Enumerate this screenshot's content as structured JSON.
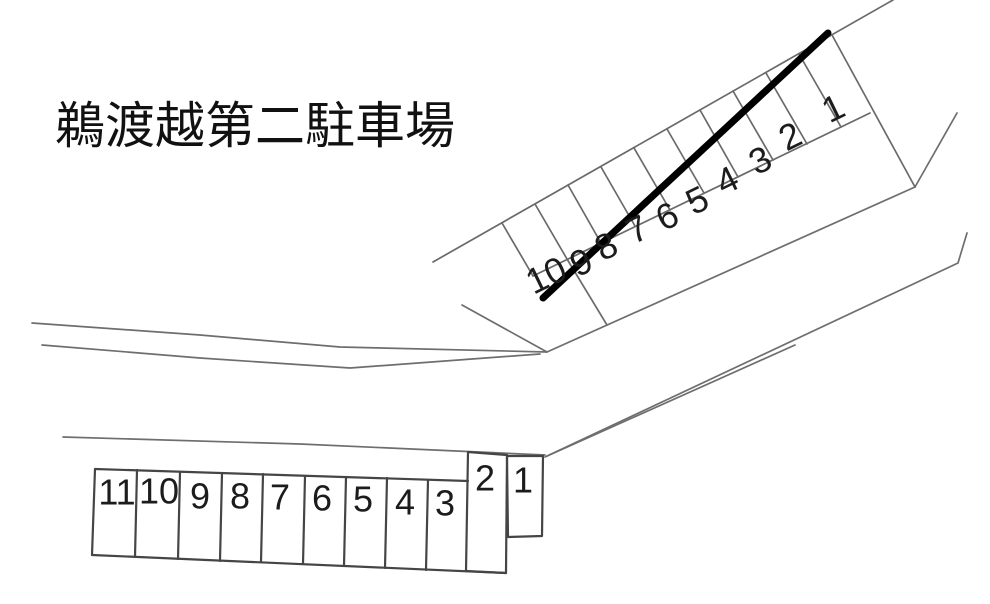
{
  "title": "鵜渡越第二駐車場",
  "upper_row": {
    "label": "diagonal parking row (upper)",
    "stalls": [
      "1",
      "2",
      "3",
      "4",
      "5",
      "6",
      "7",
      "8",
      "9",
      "10"
    ]
  },
  "lower_row": {
    "label": "straight parking row (lower)",
    "stalls": [
      "11",
      "10",
      "9",
      "8",
      "7",
      "6",
      "5",
      "4",
      "3",
      "2",
      "1"
    ]
  },
  "colors": {
    "background": "#ffffff",
    "road_line": "#6e6e6e",
    "stall_line": "#454545",
    "bold_boundary": "#000000",
    "number_text": "#1c1c1c",
    "title_text": "#111111"
  }
}
